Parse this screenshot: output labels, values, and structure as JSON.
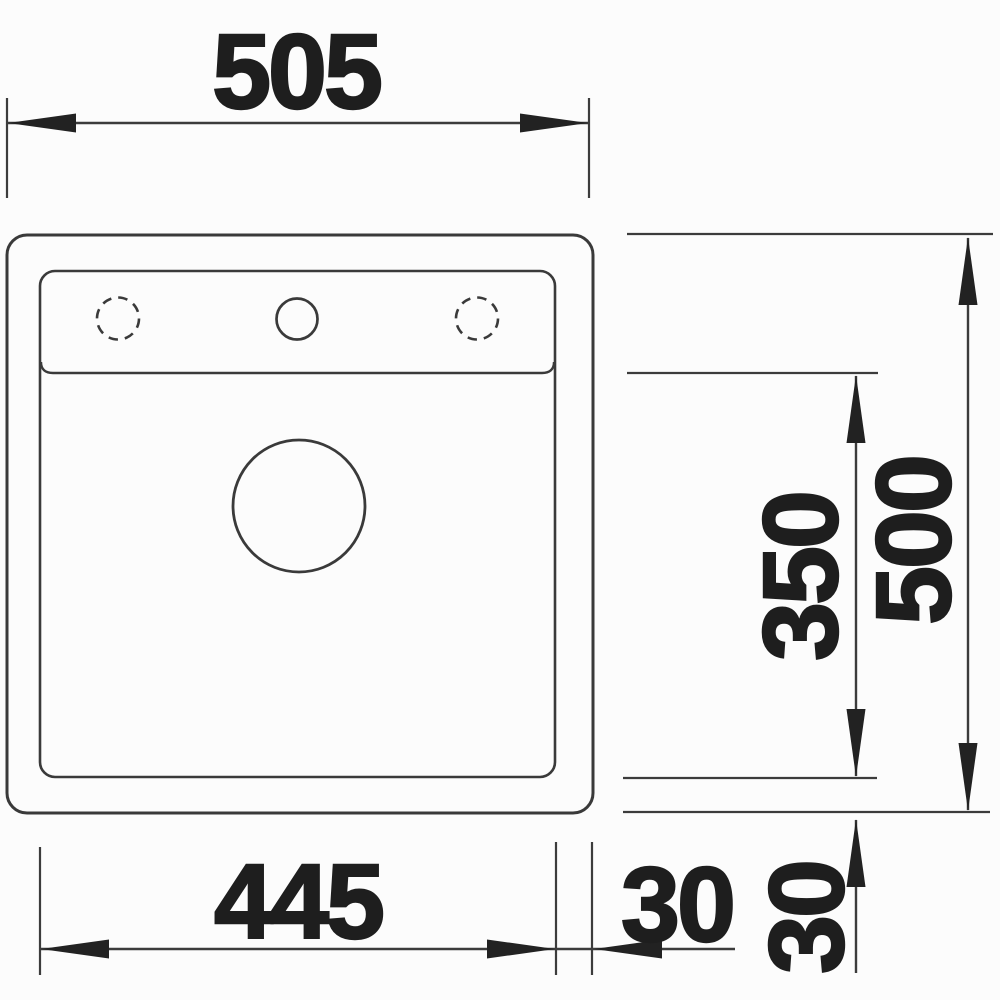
{
  "drawing": {
    "type": "technical dimension drawing, sink top view",
    "dims": {
      "overall_width": "505",
      "overall_depth": "500",
      "bowl_width": "445",
      "bowl_depth": "350",
      "rim_right_offset": "30",
      "rim_bottom_offset": "30"
    }
  }
}
